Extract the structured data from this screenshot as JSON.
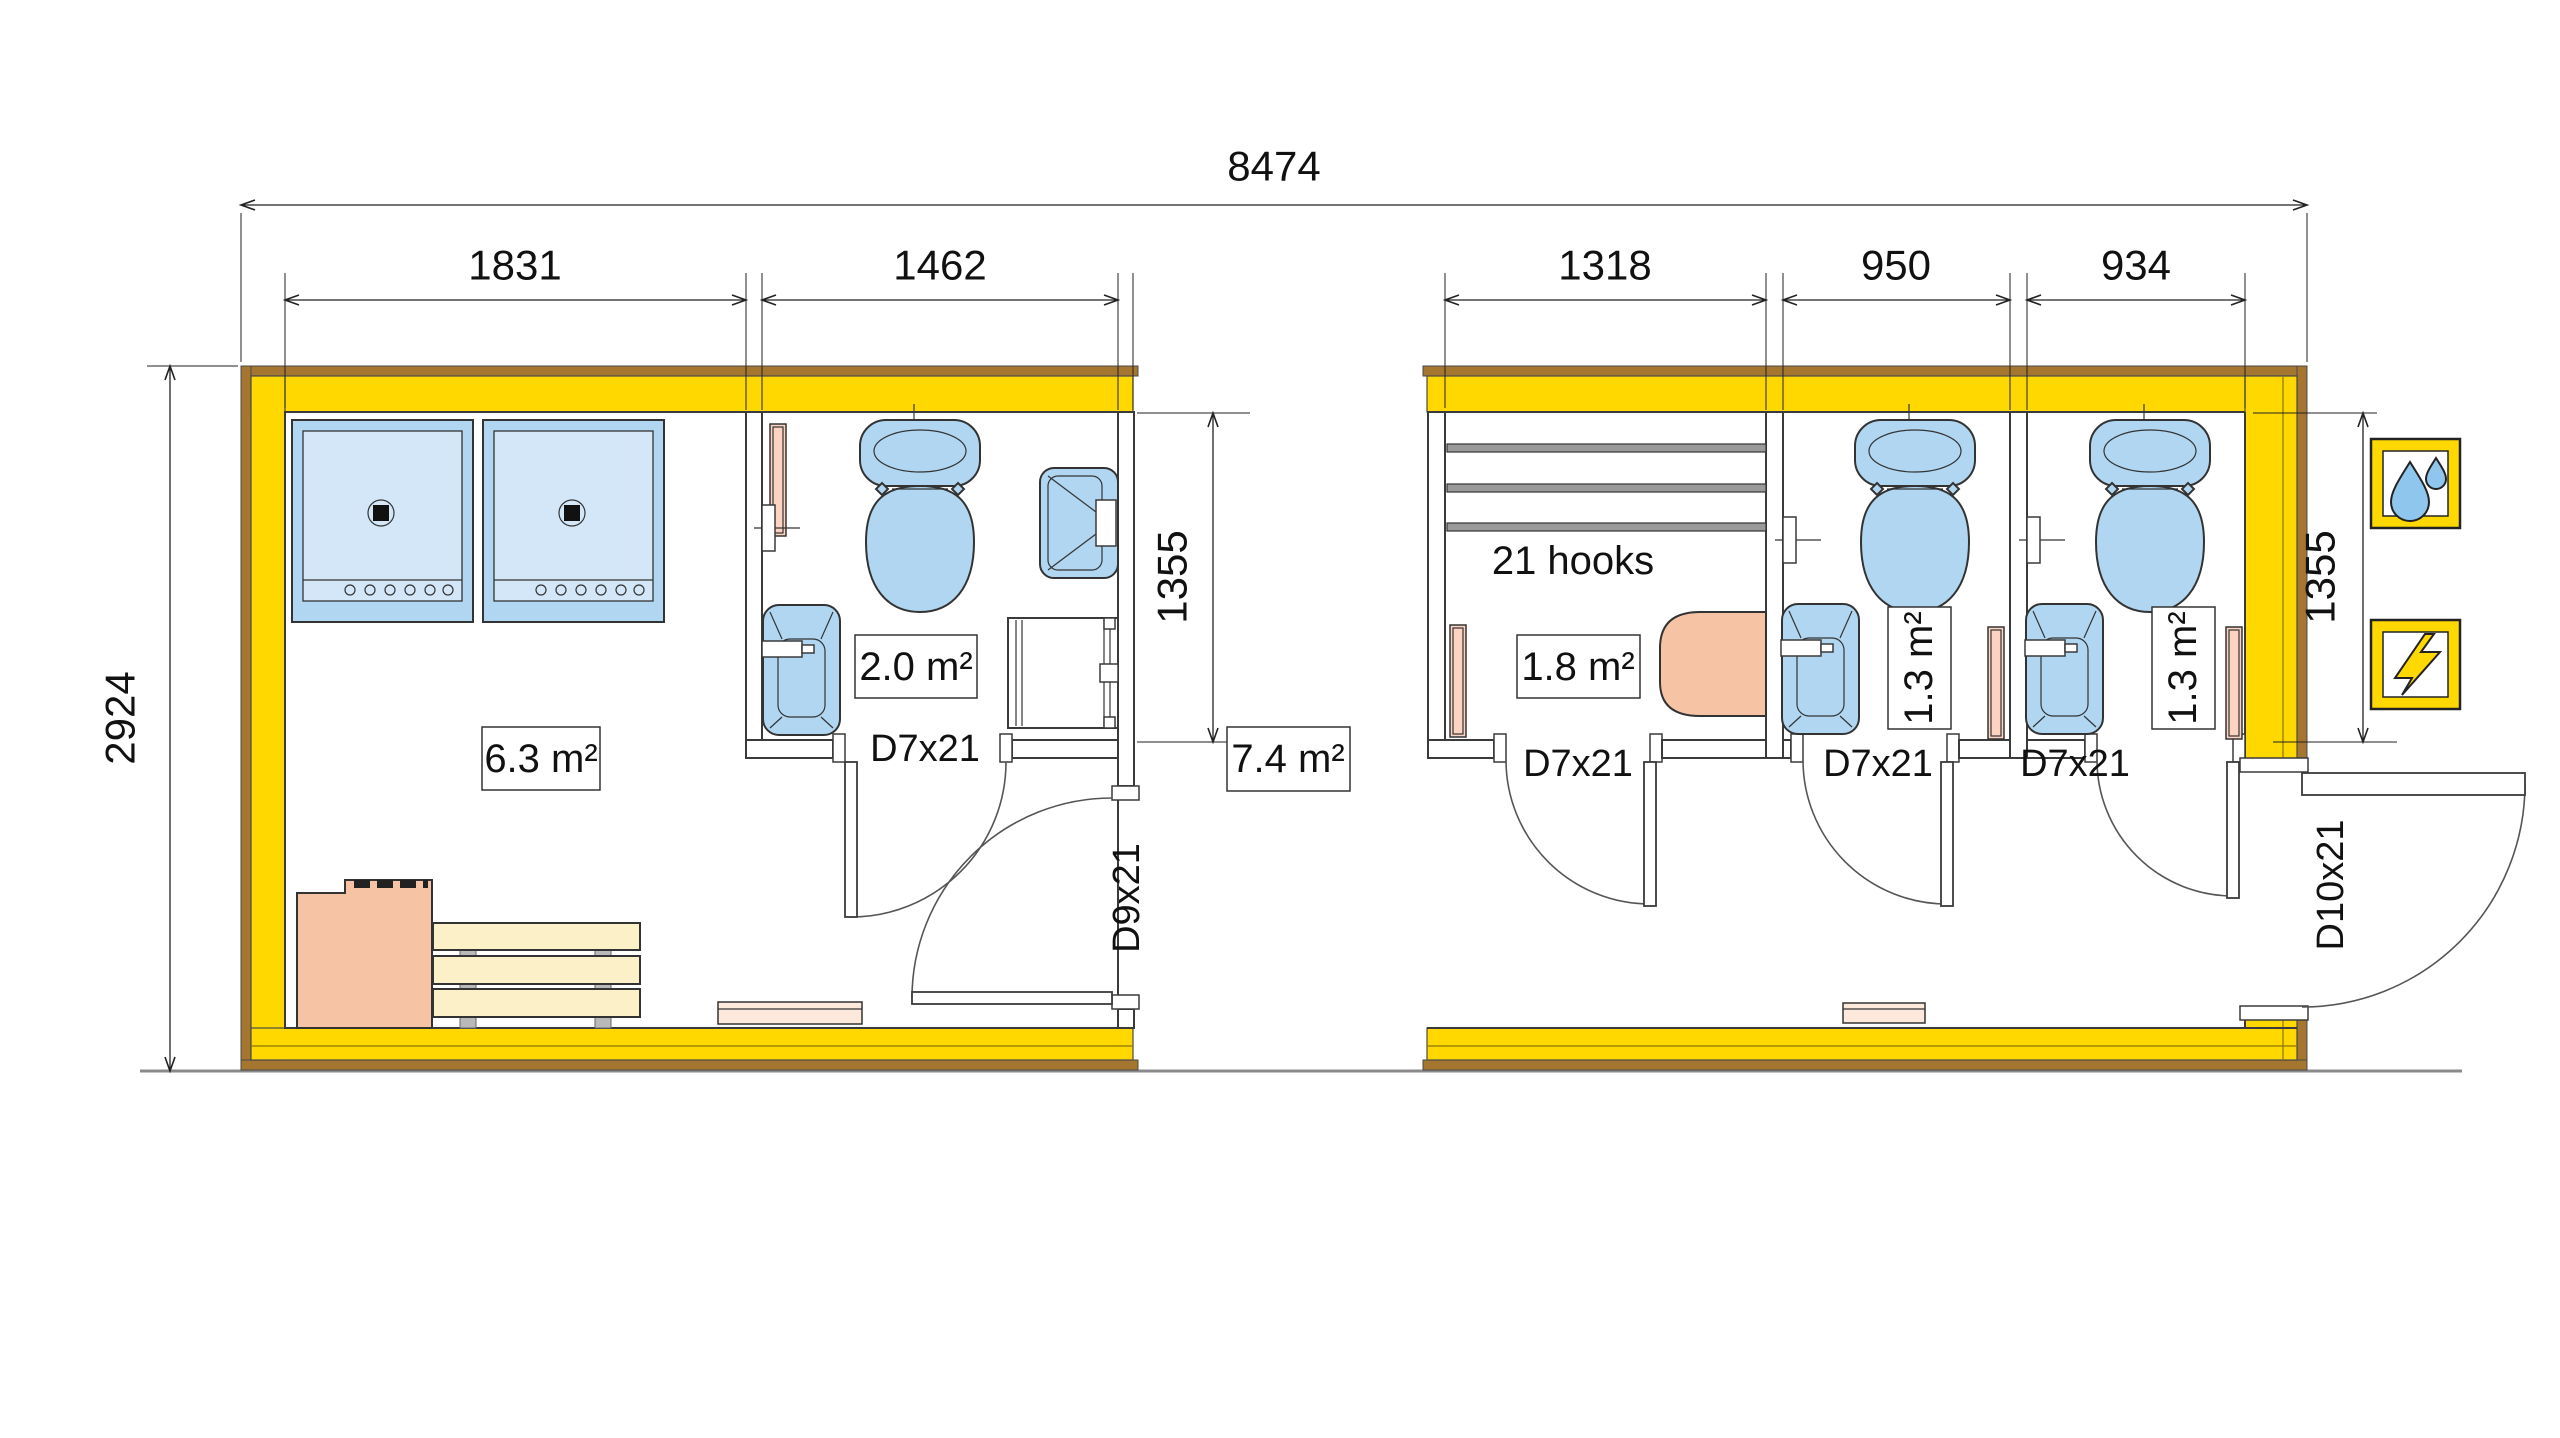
{
  "dimensions": {
    "overall_width": "8474",
    "overall_depth": "2924",
    "shower_room_width": "1831",
    "wc_room_width": "1462",
    "changing_room_width": "1318",
    "wc_cabin_1_width": "950",
    "wc_cabin_2_width": "934",
    "room_depth_left": "1355",
    "room_depth_right": "1355"
  },
  "rooms": {
    "shower_room": {
      "area": "6.3 m²"
    },
    "wc_room": {
      "area": "2.0 m²"
    },
    "corridor": {
      "area": "7.4 m²"
    },
    "changing_room": {
      "area": "1.8 m²",
      "hooks": "21 hooks"
    },
    "wc_cabin_1": {
      "area": "1.3 m²"
    },
    "wc_cabin_2": {
      "area": "1.3 m²"
    }
  },
  "doors": {
    "wc_room_door": "D7x21",
    "inner_entrance_door": "D9x21",
    "changing_room_door": "D7x21",
    "wc_cabin_1_door": "D7x21",
    "wc_cabin_2_door": "D7x21",
    "main_entrance_door": "D10x21"
  },
  "icons": {
    "water": "water-drops-icon",
    "electricity": "lightning-bolt-icon"
  },
  "colors": {
    "wall_fill": "#ffd800",
    "wall_outline": "#a5762f",
    "fixture_blue": "#b0d6f2",
    "fixture_blue_light": "#d3e7f8",
    "heater_salmon": "#f6c3a4",
    "radiator_pink": "#fbd3c0",
    "bench_wood": "#fcf0c8",
    "line": "#222222"
  }
}
